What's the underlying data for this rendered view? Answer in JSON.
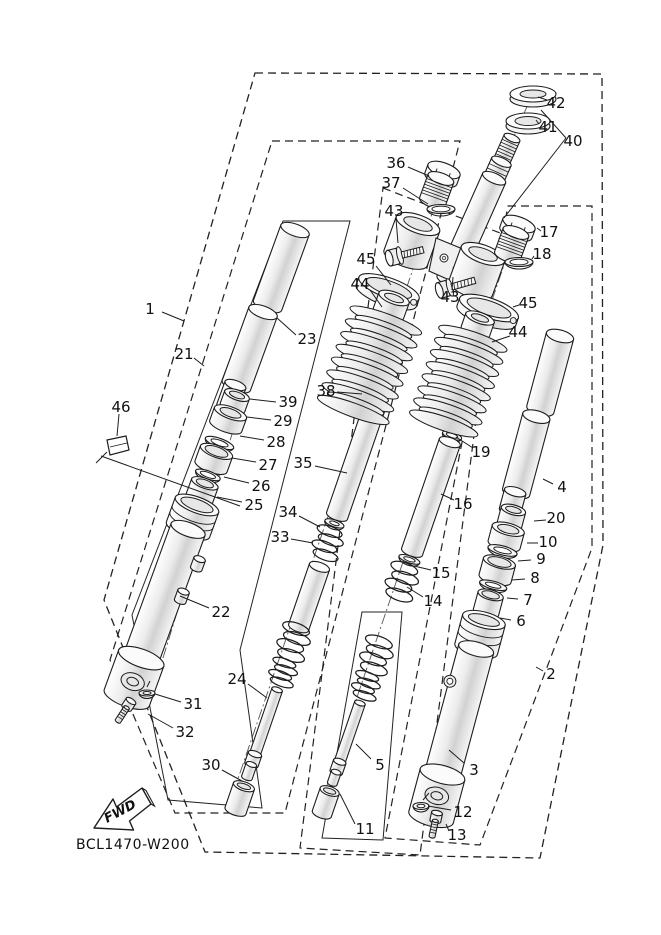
{
  "document": {
    "code": "BCL1470-W200",
    "fwd_label": "FWD"
  },
  "colors": {
    "line": "#1d1d1d",
    "background": "#ffffff"
  },
  "callout_labels": {
    "c1": "1",
    "c2": "2",
    "c3": "3",
    "c4": "4",
    "c5": "5",
    "c6": "6",
    "c7": "7",
    "c8": "8",
    "c9": "9",
    "c10": "10",
    "c11": "11",
    "c12": "12",
    "c13": "13",
    "c14": "14",
    "c15": "15",
    "c16": "16",
    "c17": "17",
    "c18": "18",
    "c19": "19",
    "c20": "20",
    "c21": "21",
    "c22": "22",
    "c23": "23",
    "c24": "24",
    "c25": "25",
    "c26": "26",
    "c27": "27",
    "c28": "28",
    "c29": "29",
    "c30": "30",
    "c31": "31",
    "c32": "32",
    "c33": "33",
    "c34": "34",
    "c35": "35",
    "c36": "36",
    "c37": "37",
    "c38": "38",
    "c39": "39",
    "c40": "40",
    "c41": "41",
    "c42": "42",
    "c43a": "43",
    "c43b": "43",
    "c44a": "44",
    "c44b": "44",
    "c45a": "45",
    "c45b": "45",
    "c46": "46"
  }
}
